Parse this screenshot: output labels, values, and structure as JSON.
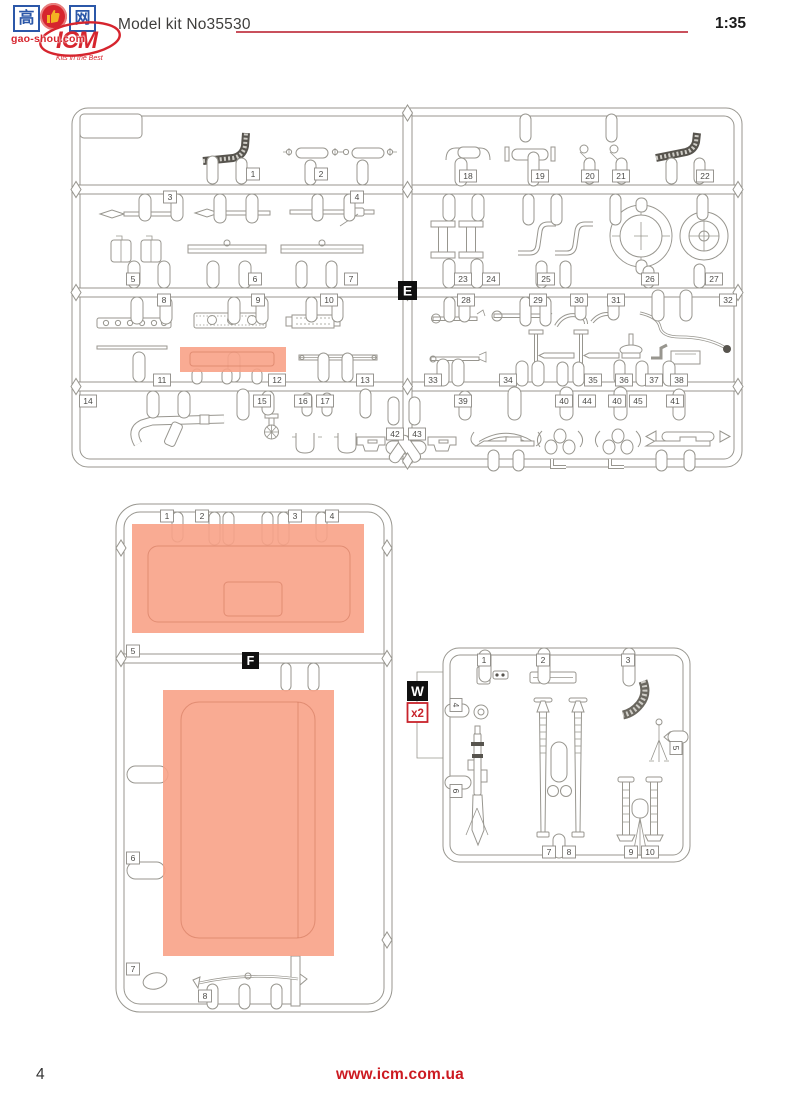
{
  "header": {
    "model_kit_label": "Model kit No35530",
    "scale": "1:35",
    "logo_text": "ICM",
    "logo_slogan": "Kits in the Best",
    "watermark": {
      "char_left": "高",
      "char_right": "网",
      "site": "gao-shou.com"
    }
  },
  "footer": {
    "page_number": "4",
    "website": "www.icm.com.ua"
  },
  "colors": {
    "accent_red": "#d6252e",
    "header_line_red": "#c9505c",
    "salmon_highlight": "#f8a287",
    "line_gray": "#98968f",
    "label_box_black": "#101010"
  },
  "sprues": {
    "e": {
      "letter": "E",
      "parts": [
        {
          "n": "1",
          "x": 253,
          "y": 174
        },
        {
          "n": "2",
          "x": 321,
          "y": 174
        },
        {
          "n": "3",
          "x": 170,
          "y": 197
        },
        {
          "n": "4",
          "x": 357,
          "y": 197
        },
        {
          "n": "5",
          "x": 133,
          "y": 279
        },
        {
          "n": "6",
          "x": 255,
          "y": 279
        },
        {
          "n": "7",
          "x": 351,
          "y": 279
        },
        {
          "n": "8",
          "x": 164,
          "y": 300
        },
        {
          "n": "9",
          "x": 258,
          "y": 300
        },
        {
          "n": "10",
          "x": 329,
          "y": 300
        },
        {
          "n": "11",
          "x": 162,
          "y": 380
        },
        {
          "n": "12",
          "x": 277,
          "y": 380
        },
        {
          "n": "13",
          "x": 365,
          "y": 380
        },
        {
          "n": "14",
          "x": 88,
          "y": 401
        },
        {
          "n": "15",
          "x": 262,
          "y": 401
        },
        {
          "n": "16",
          "x": 303,
          "y": 401
        },
        {
          "n": "17",
          "x": 325,
          "y": 401
        },
        {
          "n": "18",
          "x": 468,
          "y": 176
        },
        {
          "n": "19",
          "x": 540,
          "y": 176
        },
        {
          "n": "20",
          "x": 590,
          "y": 176
        },
        {
          "n": "21",
          "x": 621,
          "y": 176
        },
        {
          "n": "22",
          "x": 705,
          "y": 176
        },
        {
          "n": "23",
          "x": 463,
          "y": 279
        },
        {
          "n": "24",
          "x": 491,
          "y": 279
        },
        {
          "n": "25",
          "x": 546,
          "y": 279
        },
        {
          "n": "26",
          "x": 650,
          "y": 279
        },
        {
          "n": "27",
          "x": 714,
          "y": 279
        },
        {
          "n": "28",
          "x": 466,
          "y": 300
        },
        {
          "n": "29",
          "x": 538,
          "y": 300
        },
        {
          "n": "30",
          "x": 579,
          "y": 300
        },
        {
          "n": "31",
          "x": 616,
          "y": 300
        },
        {
          "n": "32",
          "x": 728,
          "y": 300
        },
        {
          "n": "33",
          "x": 433,
          "y": 380
        },
        {
          "n": "34",
          "x": 508,
          "y": 380
        },
        {
          "n": "35",
          "x": 593,
          "y": 380
        },
        {
          "n": "36",
          "x": 624,
          "y": 380
        },
        {
          "n": "37",
          "x": 654,
          "y": 380
        },
        {
          "n": "38",
          "x": 679,
          "y": 380
        },
        {
          "n": "39",
          "x": 463,
          "y": 401
        },
        {
          "n": "40",
          "x": 564,
          "y": 401
        },
        {
          "n": "44",
          "x": 587,
          "y": 401
        },
        {
          "n": "40",
          "x": 617,
          "y": 401
        },
        {
          "n": "45",
          "x": 638,
          "y": 401
        },
        {
          "n": "41",
          "x": 675,
          "y": 401
        },
        {
          "n": "42",
          "x": 395,
          "y": 434
        },
        {
          "n": "43",
          "x": 417,
          "y": 434
        }
      ],
      "highlight": {
        "x": 180,
        "y": 347,
        "w": 106,
        "h": 25
      }
    },
    "f": {
      "letter": "F",
      "parts": [
        {
          "n": "1",
          "x": 167,
          "y": 516
        },
        {
          "n": "2",
          "x": 202,
          "y": 516
        },
        {
          "n": "3",
          "x": 295,
          "y": 516
        },
        {
          "n": "4",
          "x": 332,
          "y": 516
        },
        {
          "n": "5",
          "x": 133,
          "y": 651
        },
        {
          "n": "6",
          "x": 133,
          "y": 858
        },
        {
          "n": "7",
          "x": 133,
          "y": 969
        },
        {
          "n": "8",
          "x": 205,
          "y": 996
        }
      ],
      "highlights": [
        {
          "x": 132,
          "y": 524,
          "w": 232,
          "h": 109
        },
        {
          "x": 163,
          "y": 690,
          "w": 171,
          "h": 266
        }
      ]
    },
    "w": {
      "letter": "W",
      "multiplier": "x2",
      "parts": [
        {
          "n": "1",
          "x": 484,
          "y": 660
        },
        {
          "n": "2",
          "x": 543,
          "y": 660
        },
        {
          "n": "3",
          "x": 628,
          "y": 660
        },
        {
          "n": "4",
          "x": 456,
          "y": 705,
          "rot": true
        },
        {
          "n": "5",
          "x": 676,
          "y": 748,
          "rot": true
        },
        {
          "n": "6",
          "x": 456,
          "y": 791,
          "rot": true
        },
        {
          "n": "7",
          "x": 549,
          "y": 852
        },
        {
          "n": "8",
          "x": 569,
          "y": 852
        },
        {
          "n": "9",
          "x": 631,
          "y": 852
        },
        {
          "n": "10",
          "x": 650,
          "y": 852
        }
      ]
    }
  }
}
